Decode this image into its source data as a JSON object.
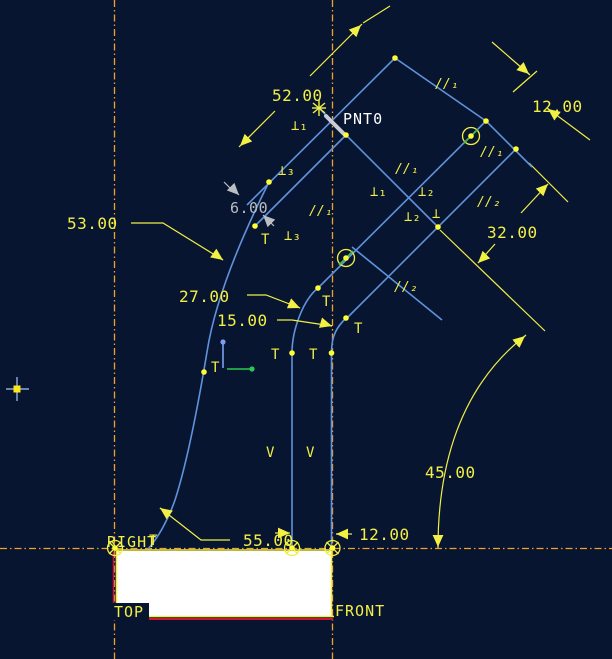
{
  "scene": {
    "background": "#081531",
    "colors": {
      "geometry_blue": "#5f93dc",
      "dimension_yellow": "#f2ef45",
      "centerline_orange": "#f0a228",
      "surface_white": "#ffffff",
      "reference_red": "#cc1438",
      "weak_dimension_gray": "#b9bdc4",
      "vertex_yellow": "#ffff33",
      "axis_green": "#27c94f",
      "axis_blue": "#7c9ff0"
    }
  },
  "labels": {
    "point": "PNT0",
    "datum_right": "RIGHT",
    "datum_top": "TOP",
    "datum_front": "FRONT"
  },
  "dimensions": {
    "length_52": "52.00",
    "offset_12_top": "12.00",
    "offset_32": "32.00",
    "radius_53": "53.00",
    "radius_27": "27.00",
    "radius_15": "15.00",
    "weak_6": "6.00",
    "angle_45": "45.00",
    "length_55": "55.00",
    "offset_12_bottom": "12.00"
  },
  "constraints": {
    "perp1": "⊥₁",
    "perp2": "⊥₂",
    "perp3": "⊥₃",
    "perp": "⊥",
    "par1": "//₁",
    "par2": "//₂",
    "tangent": "T",
    "vertical": "V"
  }
}
